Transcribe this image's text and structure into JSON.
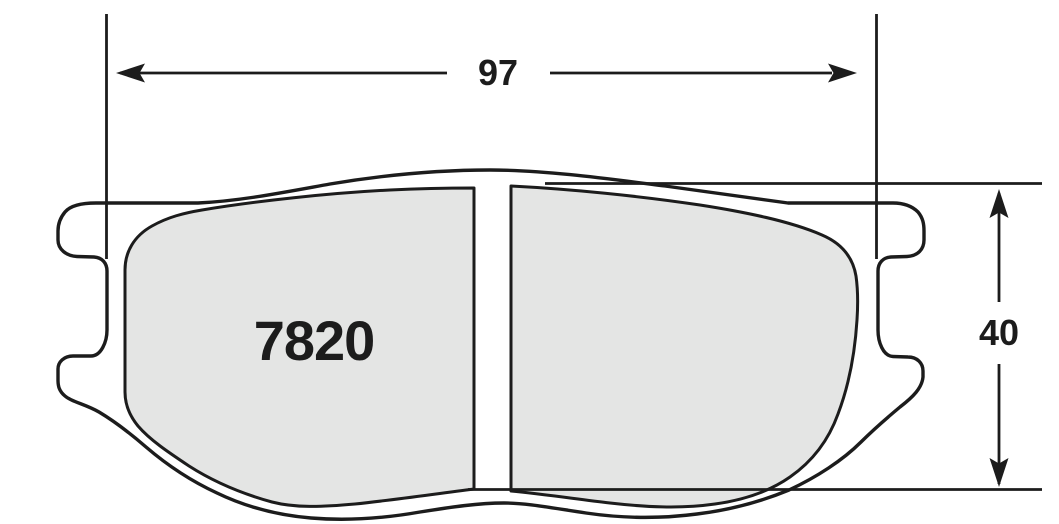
{
  "drawing": {
    "type": "brake-pad-technical-drawing",
    "part_number": "7820",
    "width_dimension": {
      "label": "97"
    },
    "height_dimension": {
      "label": "40"
    },
    "colors": {
      "line": "#1c1c1c",
      "friction_material_fill": "#e4e5e4",
      "background": "#ffffff"
    }
  }
}
